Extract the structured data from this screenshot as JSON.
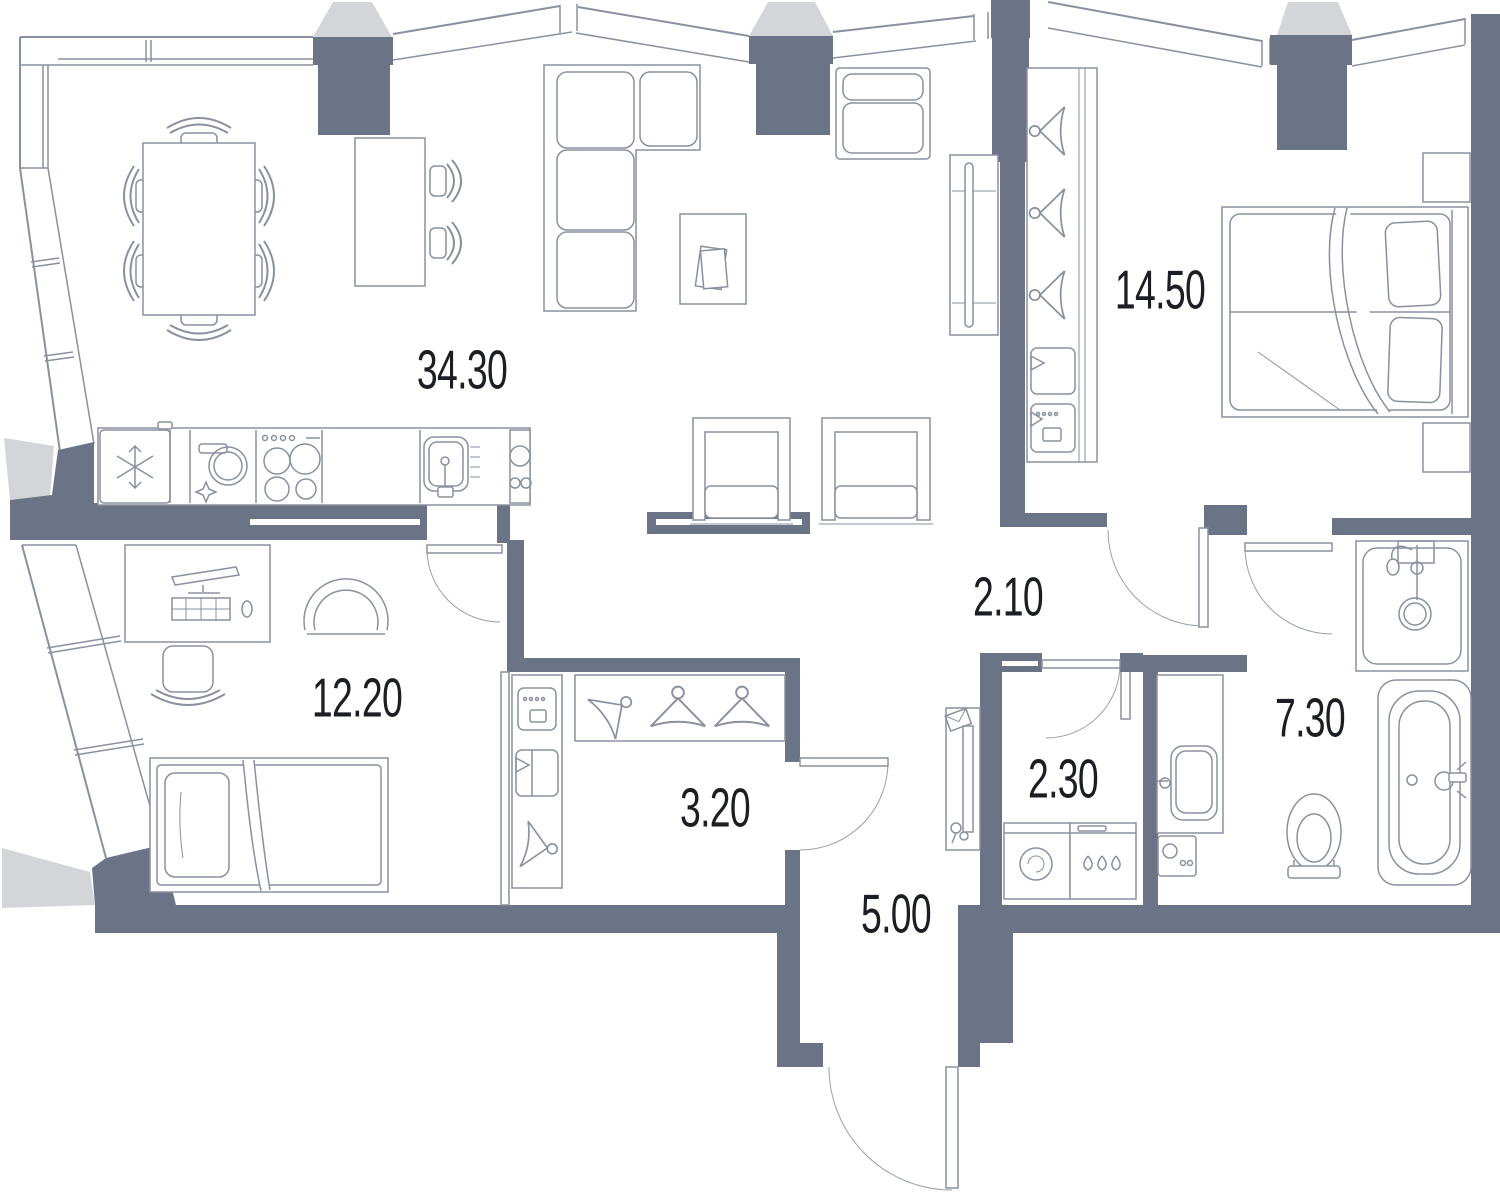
{
  "plan": {
    "type": "apartment-floor-plan",
    "area_units": "m2",
    "rooms": [
      {
        "name": "living-dining-kitchen",
        "area": "34.30"
      },
      {
        "name": "bedroom-master",
        "area": "14.50"
      },
      {
        "name": "corridor",
        "area": "2.10"
      },
      {
        "name": "bedroom-second",
        "area": "12.20"
      },
      {
        "name": "walk-in-closet",
        "area": "3.20"
      },
      {
        "name": "entrance-hall",
        "area": "5.00"
      },
      {
        "name": "laundry-room",
        "area": "2.30"
      },
      {
        "name": "bathroom",
        "area": "7.30"
      }
    ],
    "colors": {
      "wall": "#6b7487",
      "accent_light": "#d3d5d9",
      "line": "#8b90a0",
      "label": "#1c1e24",
      "background": "#ffffff"
    },
    "furniture": [
      "dining-table-six-chairs",
      "console-table-two-chairs",
      "corner-sofa",
      "coffee-table",
      "armchair",
      "tv-stand",
      "pair-lounge-chairs",
      "fridge",
      "dishwasher",
      "cooktop",
      "kitchen-sink",
      "desk-workstation",
      "desk-chair",
      "tub-chair",
      "single-bed",
      "double-bed",
      "nightstands",
      "wardrobe-hangers",
      "closet-hangers",
      "shower-cabin",
      "vanity-sink",
      "toilet",
      "bathtub",
      "washing-machine",
      "dryer",
      "hallway-console-mirror"
    ]
  }
}
